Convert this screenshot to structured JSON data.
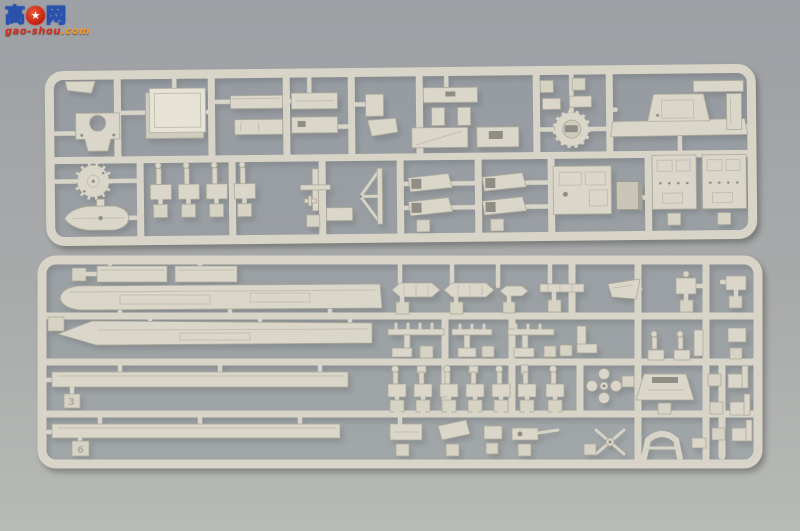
{
  "meta": {
    "type": "photograph",
    "subject": "Two injection-molded light-gray plastic model kit sprues with warship parts, photographed on a gray surface"
  },
  "watermark": {
    "char_left": "高",
    "char_right": "网",
    "gear_glyph": "★",
    "url_main": "gao-shou",
    "url_tld": ".com",
    "blue": "#2a52ad",
    "red": "#d42f1f",
    "orange": "#f59a1e"
  },
  "scene": {
    "background_top": "#9da0a4",
    "background_bottom": "#b8bab8",
    "plastic_color": "#dad7ca",
    "plastic_shadow": "#ada99a",
    "recess_color": "#8f8d85",
    "sprues": [
      {
        "id": "top",
        "description": "Upper sprue: square deckhouse block, U-bracket, superstructure strips, turret ring, winged bridge part, gear-shaped platform, ship's boat hull, davit stands, mast frames, funnel halves, detailed cabin walls"
      },
      {
        "id": "bottom",
        "description": "Lower sprue: long hull side and deck strips, ship's boats, boat booms and yardarms, searchlight and director stands, propellers, funnel cap, gun mount, shaft struts, crane brackets"
      }
    ],
    "tags": [
      {
        "number": "6"
      },
      {
        "number": "3"
      }
    ]
  }
}
